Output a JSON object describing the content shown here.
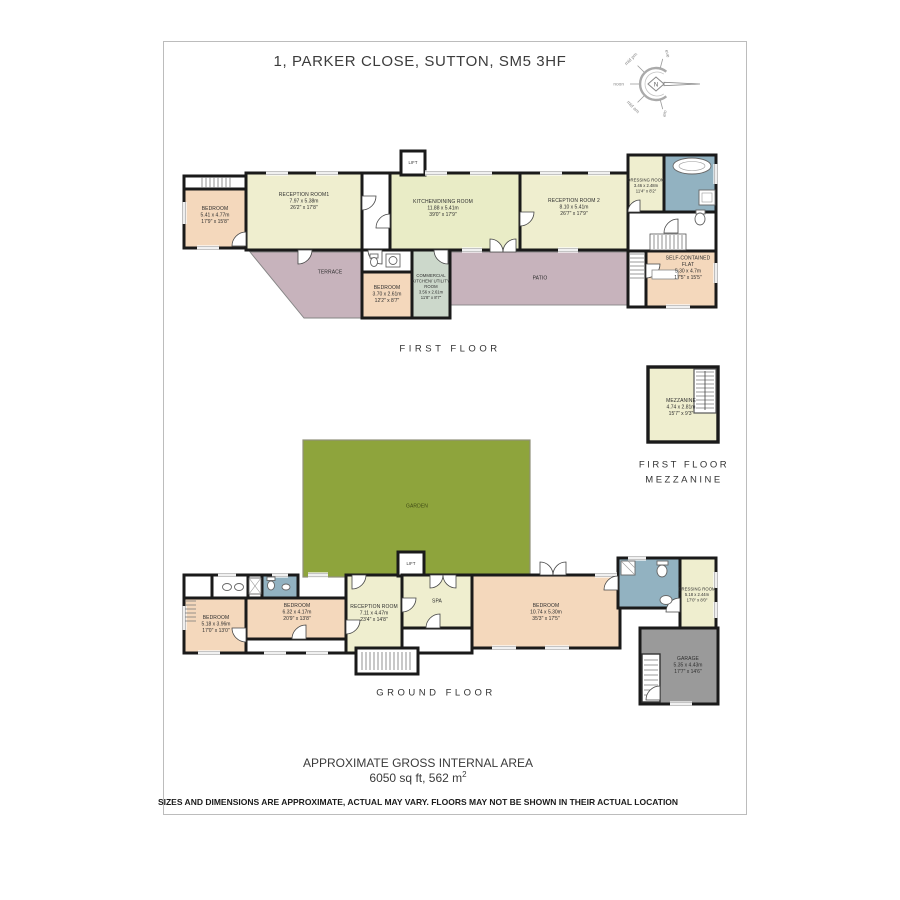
{
  "title": "1, PARKER CLOSE, SUTTON, SM5 3HF",
  "compass": {
    "needle": "N",
    "labels": {
      "eve": "eve",
      "mid_pm": "mid pm",
      "noon": "noon",
      "mid_am": "mid am",
      "am": "am"
    }
  },
  "first_floor": {
    "caption": "FIRST FLOOR",
    "rooms": {
      "bedroom": {
        "name": "BEDROOM",
        "metric": "5.41 x 4.77m",
        "imperial": "17'9\" x 15'8\""
      },
      "reception1": {
        "name": "RECEPTION ROOM1",
        "metric": "7.97 x 5.38m",
        "imperial": "26'2\" x 17'8\""
      },
      "kitchen_dining": {
        "name": "KITCHEN/DINING ROOM",
        "metric": "11.88 x 5.41m",
        "imperial": "39'0\" x 17'9\""
      },
      "reception2": {
        "name": "RECEPTION ROOM 2",
        "metric": "8.10 x 5.41m",
        "imperial": "26'7\" x 17'9\""
      },
      "dressing": {
        "name": "DRESSING ROOM",
        "metric": "3.46 x 2.48m",
        "imperial": "11'4\" x 8'2\""
      },
      "flat": {
        "name": "SELF-CONTAINED FLAT",
        "metric": "5.30 x 4.7m",
        "imperial": "17'5\" x 15'5\""
      },
      "terrace": {
        "name": "TERRACE"
      },
      "bedroom2": {
        "name": "BEDROOM",
        "metric": "3.70 x 2.61m",
        "imperial": "12'2\" x 8'7\""
      },
      "commercial": {
        "name": "COMMERCIAL KITCHEN/ UTILITY ROOM",
        "metric": "3.56 x 2.61m",
        "imperial": "11'8\" x 8'7\""
      },
      "patio": {
        "name": "PATIO"
      },
      "lift": {
        "name": "LIFT"
      }
    }
  },
  "mezzanine": {
    "caption_line1": "FIRST FLOOR",
    "caption_line2": "MEZZANINE",
    "room": {
      "name": "MEZZANINE",
      "metric": "4.74 x 2.81m",
      "imperial": "15'7\" x 9'3\""
    }
  },
  "ground_floor": {
    "caption": "GROUND FLOOR",
    "rooms": {
      "garden": {
        "name": "GARDEN"
      },
      "lift": {
        "name": "LIFT"
      },
      "reception": {
        "name": "RECEPTION ROOM",
        "metric": "7.11 x 4.47m",
        "imperial": "23'4\" x 14'8\""
      },
      "spa": {
        "name": "SPA"
      },
      "bedroom1": {
        "name": "BEDROOM",
        "metric": "5.18 x 3.96m",
        "imperial": "17'0\" x 13'0\""
      },
      "bedroom2": {
        "name": "BEDROOM",
        "metric": "6.32 x 4.17m",
        "imperial": "20'9\" x 13'8\""
      },
      "bedroom3": {
        "name": "BEDROOM",
        "metric": "10.74 x 5.30m",
        "imperial": "35'3\" x 17'5\""
      },
      "dressing": {
        "name": "DRESSING ROOM",
        "metric": "5.18 x 2.44m",
        "imperial": "17'0\" x 8'0\""
      },
      "garage": {
        "name": "GARAGE",
        "metric": "5.35 x 4.43m",
        "imperial": "17'7\" x 14'6\""
      }
    }
  },
  "footer": {
    "area_heading": "APPROXIMATE GROSS INTERNAL AREA",
    "area_value": "6050 sq ft, 562 m",
    "area_sup": "2",
    "disclaimer": "SIZES AND DIMENSIONS ARE APPROXIMATE, ACTUAL MAY VARY. FLOORS MAY NOT BE SHOWN IN THEIR ACTUAL LOCATION"
  },
  "palette": {
    "walls": "#1a1a1a",
    "cream": "#efeecf",
    "kitchen_green": "#e9ecc6",
    "peach": "#f4d8bc",
    "bathroom_blue": "#92b2c1",
    "terrace_mauve": "#c7b3bc",
    "utility_sage": "#ccd8cb",
    "garden_olive": "#8ea43c",
    "garage_grey": "#9a9a9a"
  }
}
